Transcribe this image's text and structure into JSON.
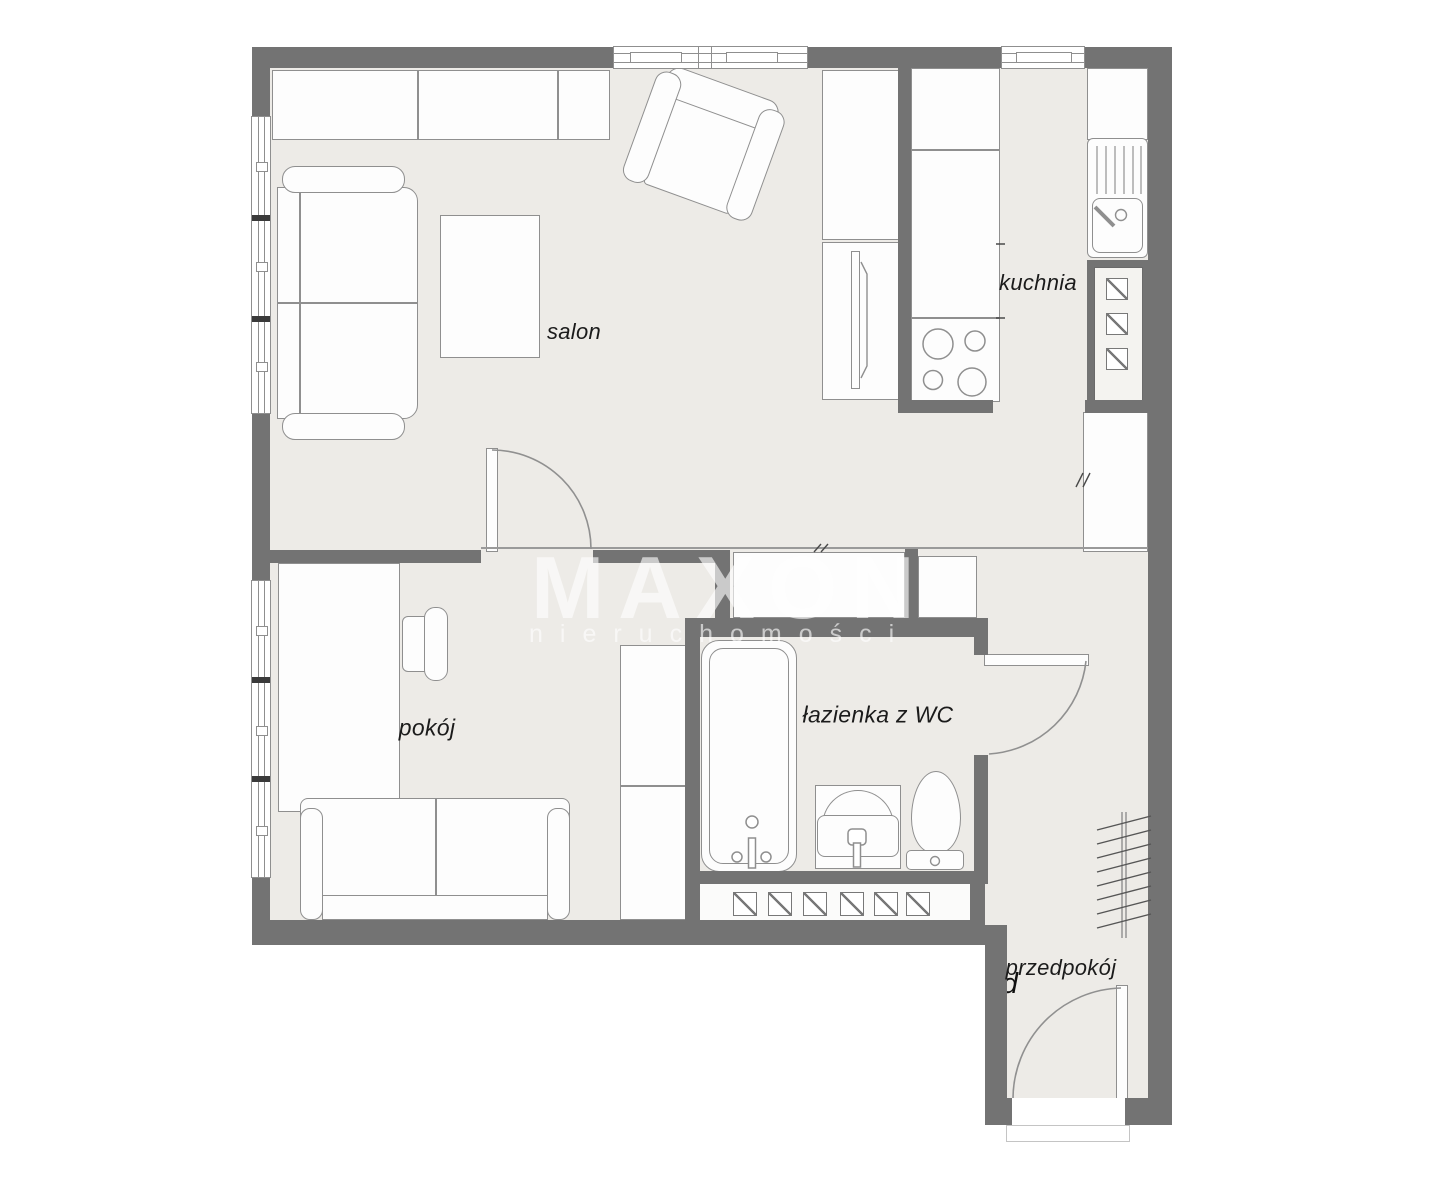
{
  "floorplan": {
    "rooms": [
      {
        "id": "salon",
        "label": "salon"
      },
      {
        "id": "kuchnia",
        "label": "kuchnia"
      },
      {
        "id": "pokoj",
        "label": "pokój"
      },
      {
        "id": "lazienka",
        "label": "łazienka z WC"
      },
      {
        "id": "przedpokoj",
        "label": "przedpokój"
      }
    ],
    "watermark": {
      "line1": "MAXON",
      "line2": "nieruchomości"
    },
    "disclaimer_lines": [
      "Plan ma charakter informacyjny, przedstawia obecny układ",
      "pomieszczeń."
    ],
    "colors": {
      "wall": "#737373",
      "floor": "#edebe7",
      "outline": "#8f8f8f",
      "text": "#1b1b1b"
    }
  }
}
